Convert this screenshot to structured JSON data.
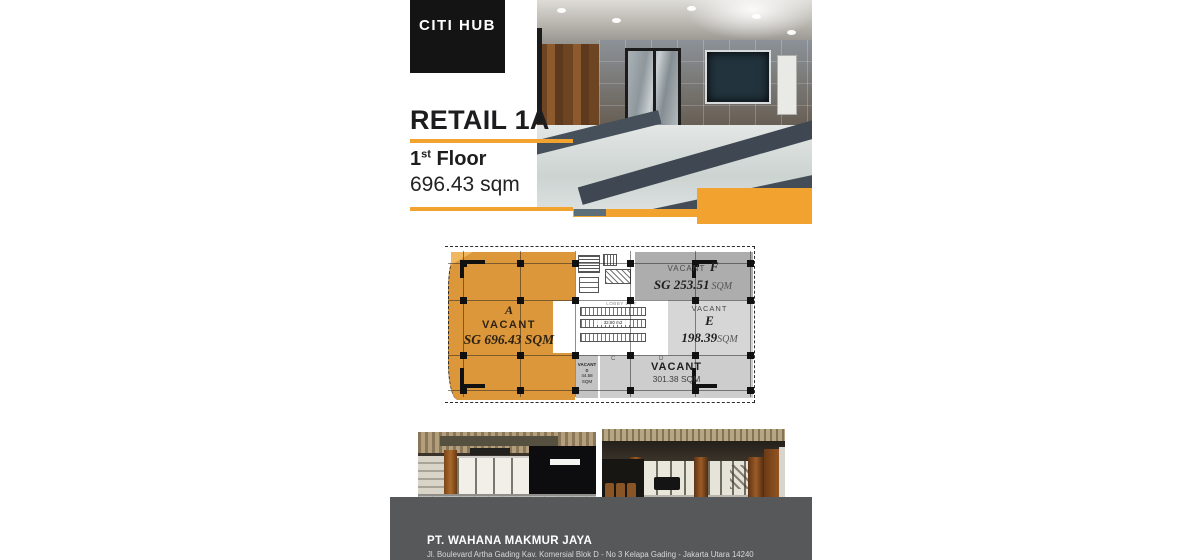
{
  "colors": {
    "accent": "#F2A32F",
    "plan_orange": "#DC973B",
    "footer_bg": "#57585A",
    "logo_bg": "#141414"
  },
  "brand": {
    "logo": "CITI HUB"
  },
  "header": {
    "title": "RETAIL 1A",
    "floor_number": "1",
    "floor_suffix": "st",
    "floor_word": "Floor",
    "area": "696.43 sqm"
  },
  "floor_plan": {
    "unit_a": {
      "letter": "A",
      "status": "VACANT",
      "area": "SG 696.43 SQM"
    },
    "unit_f": {
      "status": "VACANT",
      "letter": "F",
      "area": "SG 253.51",
      "area_unit": "SQM"
    },
    "unit_e": {
      "status": "VACANT",
      "letter": "E",
      "area": "198.39",
      "area_unit": "SQM"
    },
    "unit_b": {
      "status": "VACANT",
      "letter": "B",
      "area": "44.58",
      "area_unit": "SQM"
    },
    "unit_cd": {
      "status": "VACANT",
      "area": "301.38 SQM",
      "grid_left": "C",
      "grid_right": "D"
    },
    "core": {
      "label_top": "LOBBY LIFT",
      "label_mid": "32.80 m2"
    },
    "grid": {
      "cols": [
        18,
        75,
        130,
        185,
        250,
        305
      ],
      "rows": [
        16,
        53,
        108,
        143
      ]
    }
  },
  "footer": {
    "company": "PT. WAHANA MAKMUR JAYA",
    "address": "Jl. Boulevard Artha Gading Kav. Komersial Blok D - No 3 Kelapa Gading - Jakarta Utara 14240"
  }
}
